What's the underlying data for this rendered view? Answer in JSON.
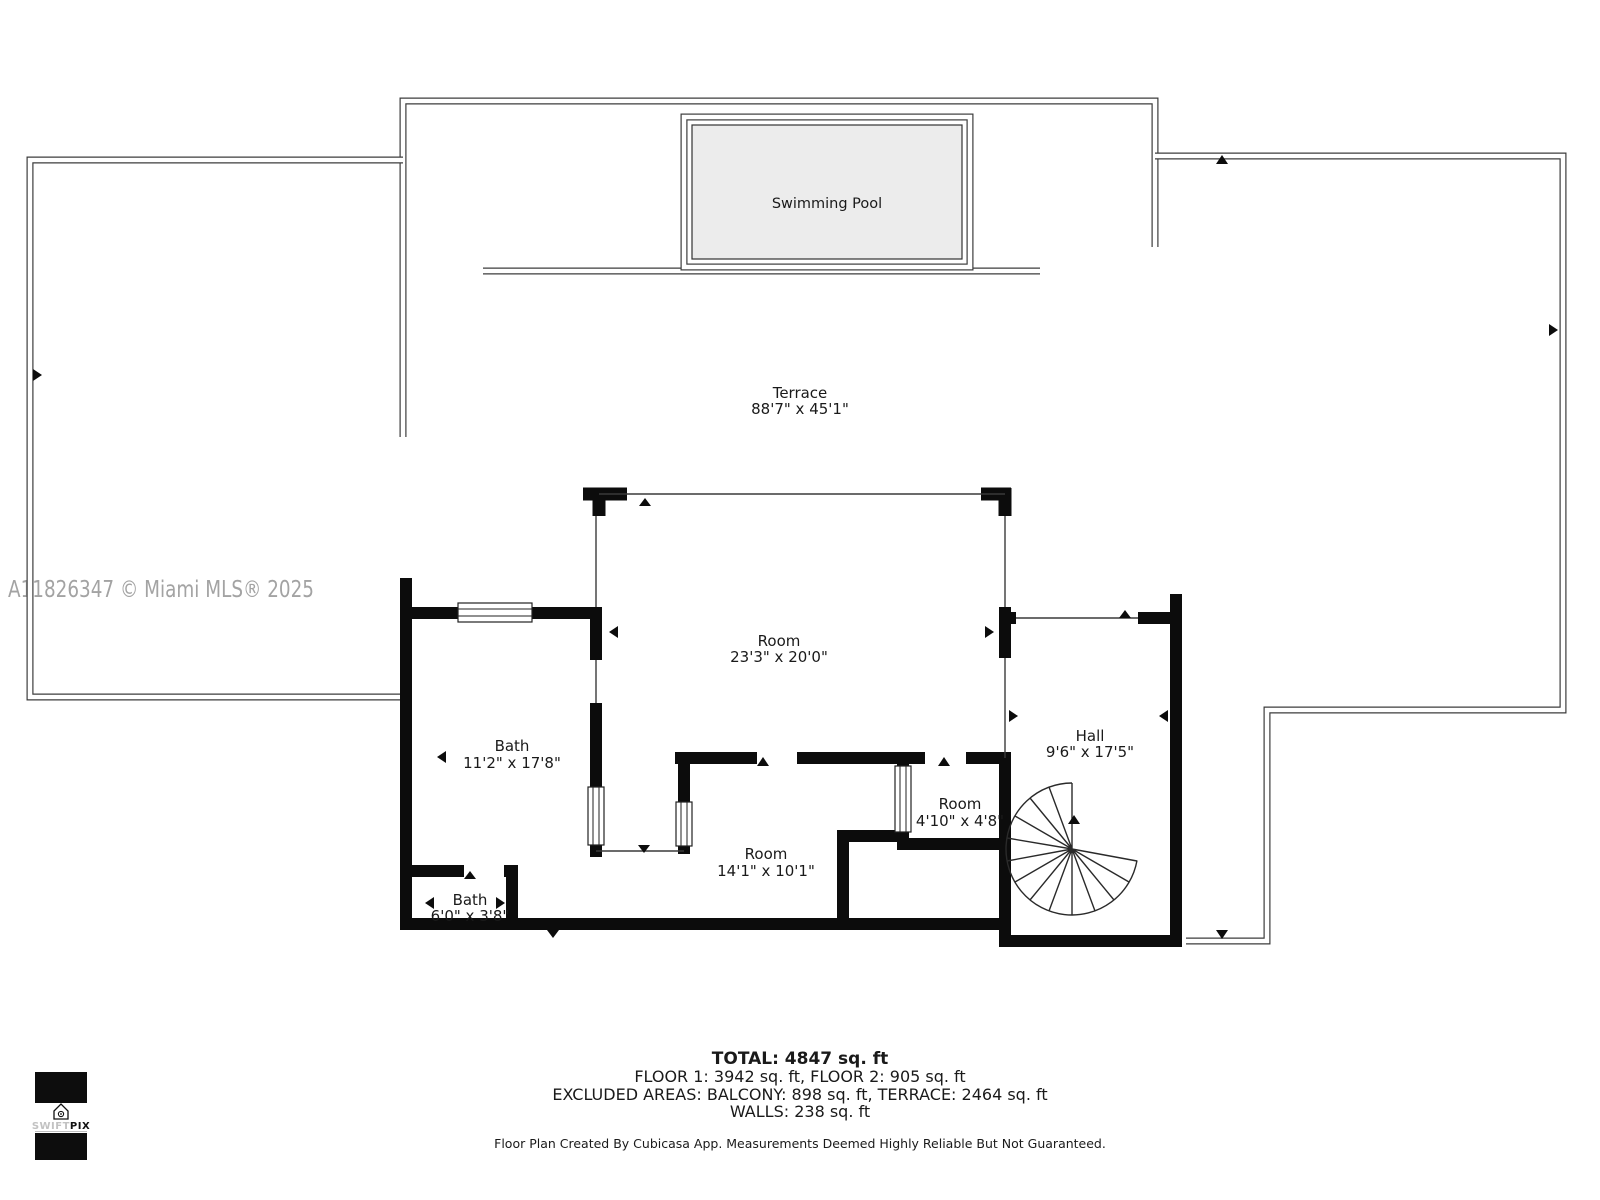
{
  "watermark": {
    "text": "A11826347 © Miami MLS® 2025"
  },
  "pool": {
    "label": "Swimming Pool"
  },
  "rooms": {
    "terrace": {
      "name": "Terrace",
      "dims": "88'7\" x 45'1\""
    },
    "main": {
      "name": "Room",
      "dims": "23'3\" x 20'0\""
    },
    "bath_large": {
      "name": "Bath",
      "dims": "11'2\" x 17'8\""
    },
    "hall": {
      "name": "Hall",
      "dims": "9'6\" x 17'5\""
    },
    "closet": {
      "name": "Room",
      "dims": "4'10\" x 4'8\""
    },
    "middle": {
      "name": "Room",
      "dims": "14'1\" x 10'1\""
    },
    "bath_small": {
      "name": "Bath",
      "dims": "6'0\" x 3'8\""
    }
  },
  "summary": {
    "total": "TOTAL: 4847 sq. ft",
    "floors": "FLOOR 1: 3942 sq. ft, FLOOR 2: 905 sq. ft",
    "excluded": "EXCLUDED AREAS: BALCONY: 898 sq. ft, TERRACE: 2464 sq. ft",
    "walls": "WALLS: 238 sq. ft"
  },
  "footer": {
    "disclaimer": "Floor Plan Created By Cubicasa App. Measurements Deemed Highly Reliable But Not Guaranteed."
  },
  "logo": {
    "swift": "SWIFT",
    "pix": "PIX"
  },
  "colors": {
    "pool_fill": "#ececec",
    "wall": "#0c0c0c",
    "watermark": "#a3a3a3"
  }
}
